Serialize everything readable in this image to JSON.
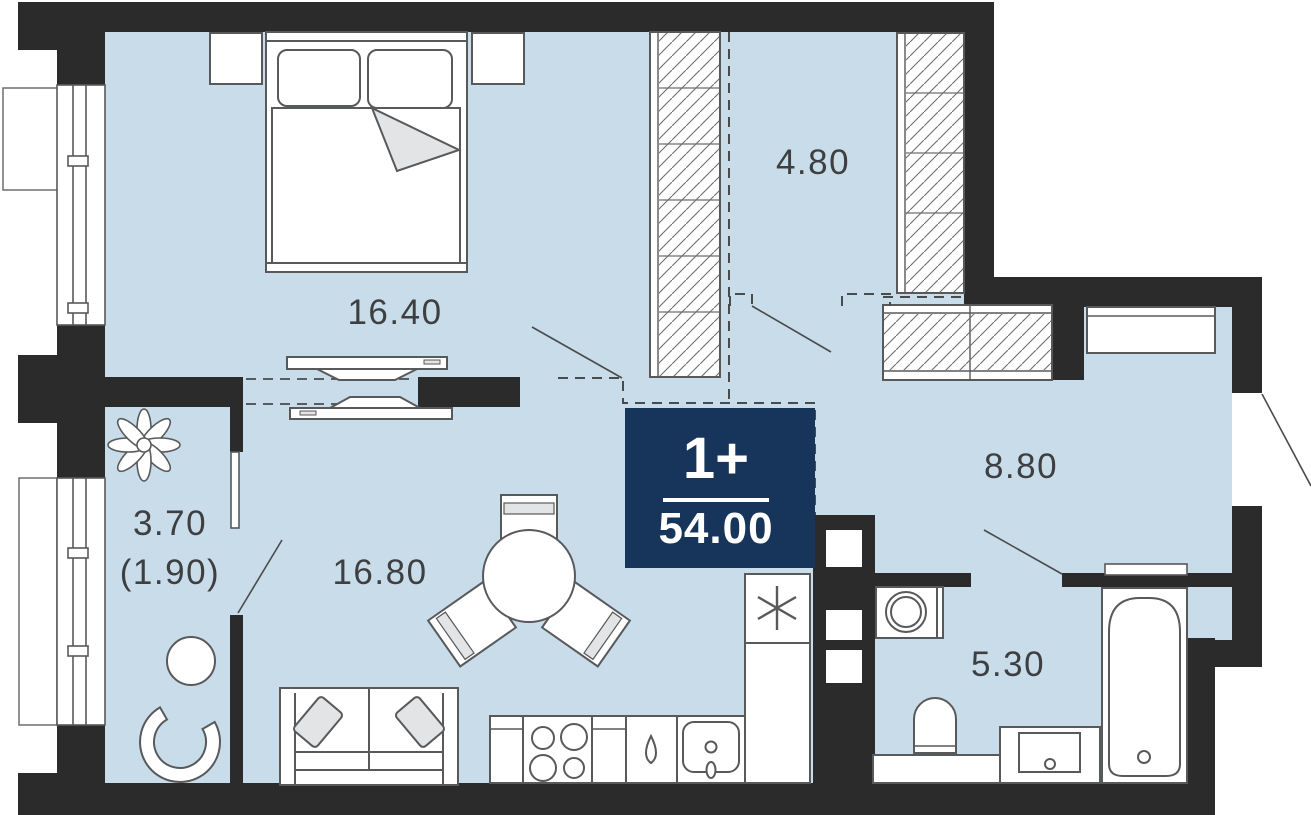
{
  "plan": {
    "badge": {
      "type": "1+",
      "area": "54.00"
    },
    "rooms": [
      {
        "id": "bedroom",
        "area": "16.40"
      },
      {
        "id": "corridor",
        "area": "4.80"
      },
      {
        "id": "hallway",
        "area": "8.80"
      },
      {
        "id": "living-kitchen",
        "area": "16.80"
      },
      {
        "id": "balcony",
        "area": "3.70",
        "area_reduced": "(1.90)"
      },
      {
        "id": "bathroom",
        "area": "5.30"
      }
    ],
    "colors": {
      "floor": "#c9dcea",
      "wall": "#2b2b2b",
      "badge": "#17345a",
      "outline": "#58595b",
      "soft_gray": "#e3e4e5",
      "label": "#3e3f41"
    },
    "furniture_icons": [
      "double-bed",
      "nightstand",
      "wardrobe",
      "sliding-door",
      "sofa",
      "dining-table",
      "chair",
      "kitchen-counter",
      "stove",
      "kitchen-sink",
      "fridge",
      "washing-machine",
      "toilet",
      "bathtub",
      "vanity-sink",
      "plant",
      "balcony-table",
      "balcony-chair",
      "entrance-door"
    ]
  }
}
